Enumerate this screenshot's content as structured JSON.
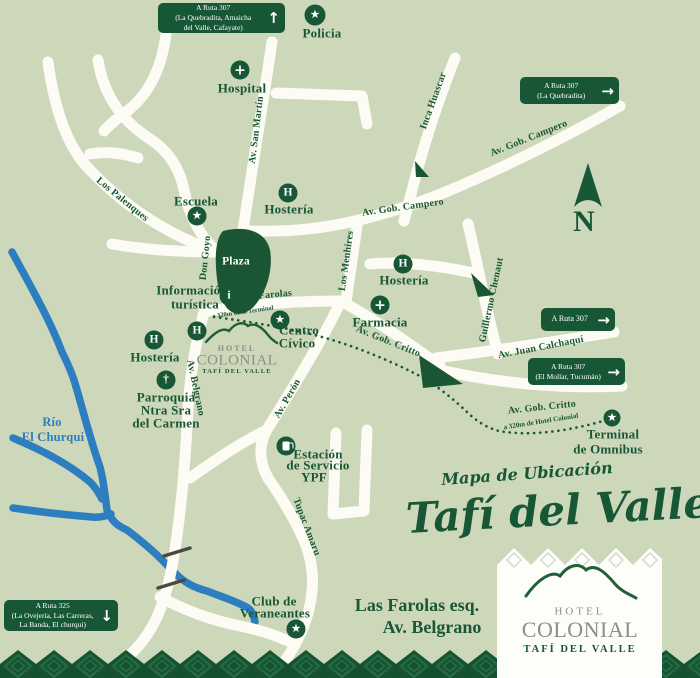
{
  "colors": {
    "background": "#cdd7ba",
    "road": "#fcfcf4",
    "green": "#185736",
    "river_blue": "#2d7ec1",
    "logo_gray": "#8e8e88",
    "band_green": "#155130"
  },
  "signs": {
    "top_left": {
      "line1": "A Ruta 307",
      "line2": "(La Quebradita, Amaicha",
      "line3": "del Valle, Cafayate)",
      "direction": "up",
      "arrow": "↑"
    },
    "top_right": {
      "line1": "A Ruta 307",
      "line2": "(La Quebradita)",
      "direction": "right",
      "arrow": "→"
    },
    "mid_right": {
      "line1": "A Ruta 307",
      "direction": "right",
      "arrow": "→"
    },
    "mollar": {
      "line1": "A Ruta 307",
      "line2": "(El Mollar, Tucumán)",
      "direction": "right",
      "arrow": "→"
    },
    "bottom_left": {
      "line1": "A Ruta 325",
      "line2": "(La Ovejería, Las Carreras,",
      "line3": "La Banda, El churquí)",
      "direction": "down",
      "arrow": "↓"
    }
  },
  "streets": {
    "san_martin": "Av. San Martín",
    "inca_huascar": "Inca Huascar",
    "campero_east": "Av. Gob. Campero",
    "campero_west": "Av. Gob. Campero",
    "los_palenques": "Los Palenques",
    "don_goyo": "Don Goyo",
    "los_menhires": "Los Menhires",
    "guillermo_chenaut": "Guillermo Chenaut",
    "las_farolas": "Las Farolas",
    "critto_diagonal": "Av. Gob. Critto",
    "juan_calchaqui": "Av. Juan Calchaquí",
    "critto_east": "Av. Gob. Critto",
    "belgrano": "Av. Belgrano",
    "peron": "Av. Perón",
    "tupac_amaru": "Tupac Amaru"
  },
  "pois": {
    "policia": {
      "label": "Policia",
      "icon": "★"
    },
    "hospital": {
      "label": "Hospital",
      "icon": "+"
    },
    "escuela": {
      "label": "Escuela",
      "icon": "★"
    },
    "hosteria_north": {
      "label": "Hostería",
      "icon": "H"
    },
    "hosteria_center": {
      "label": "Hostería",
      "icon": "H"
    },
    "hosteria_west": {
      "label": "Hostería",
      "icon": "H"
    },
    "farmacia": {
      "label": "Farmacia",
      "icon": "+"
    },
    "parroquia": {
      "line1": "Parroquia",
      "line2": "Ntra Sra",
      "line3": "del Carmen",
      "icon": "†"
    },
    "info_turistica": {
      "line1": "Información",
      "line2": "turística",
      "icon": "i"
    },
    "centro_civico": {
      "line1": "Centro",
      "line2": "Cívico",
      "icon": "★"
    },
    "estacion_ypf": {
      "line1": "Estación",
      "line2": "de Servicio",
      "line3": "YPF"
    },
    "club_veraneantes": {
      "line1": "Club de",
      "line2": "Veraneantes",
      "icon": "★"
    },
    "terminal": {
      "line1": "Terminal",
      "line2": "de Omnibus",
      "icon": "★"
    },
    "hotel_marker": {
      "icon": "H"
    },
    "plaza": {
      "label": "Plaza"
    }
  },
  "river_label": {
    "line1": "Río",
    "line2": "El Churqui"
  },
  "notes": {
    "to_terminal": "a 320m de la Terminal",
    "to_hotel": "a 320m de Hotel Colonial"
  },
  "compass": {
    "label": "N"
  },
  "title": {
    "kicker": "Mapa de Ubicación",
    "name": "Tafí del Valle"
  },
  "address": {
    "line1": "Las Farolas esq.",
    "line2": "Av. Belgrano"
  },
  "logo": {
    "hotel": "HOTEL",
    "colonial": "COLONIAL",
    "tagline": "TAFÍ DEL VALLE"
  }
}
